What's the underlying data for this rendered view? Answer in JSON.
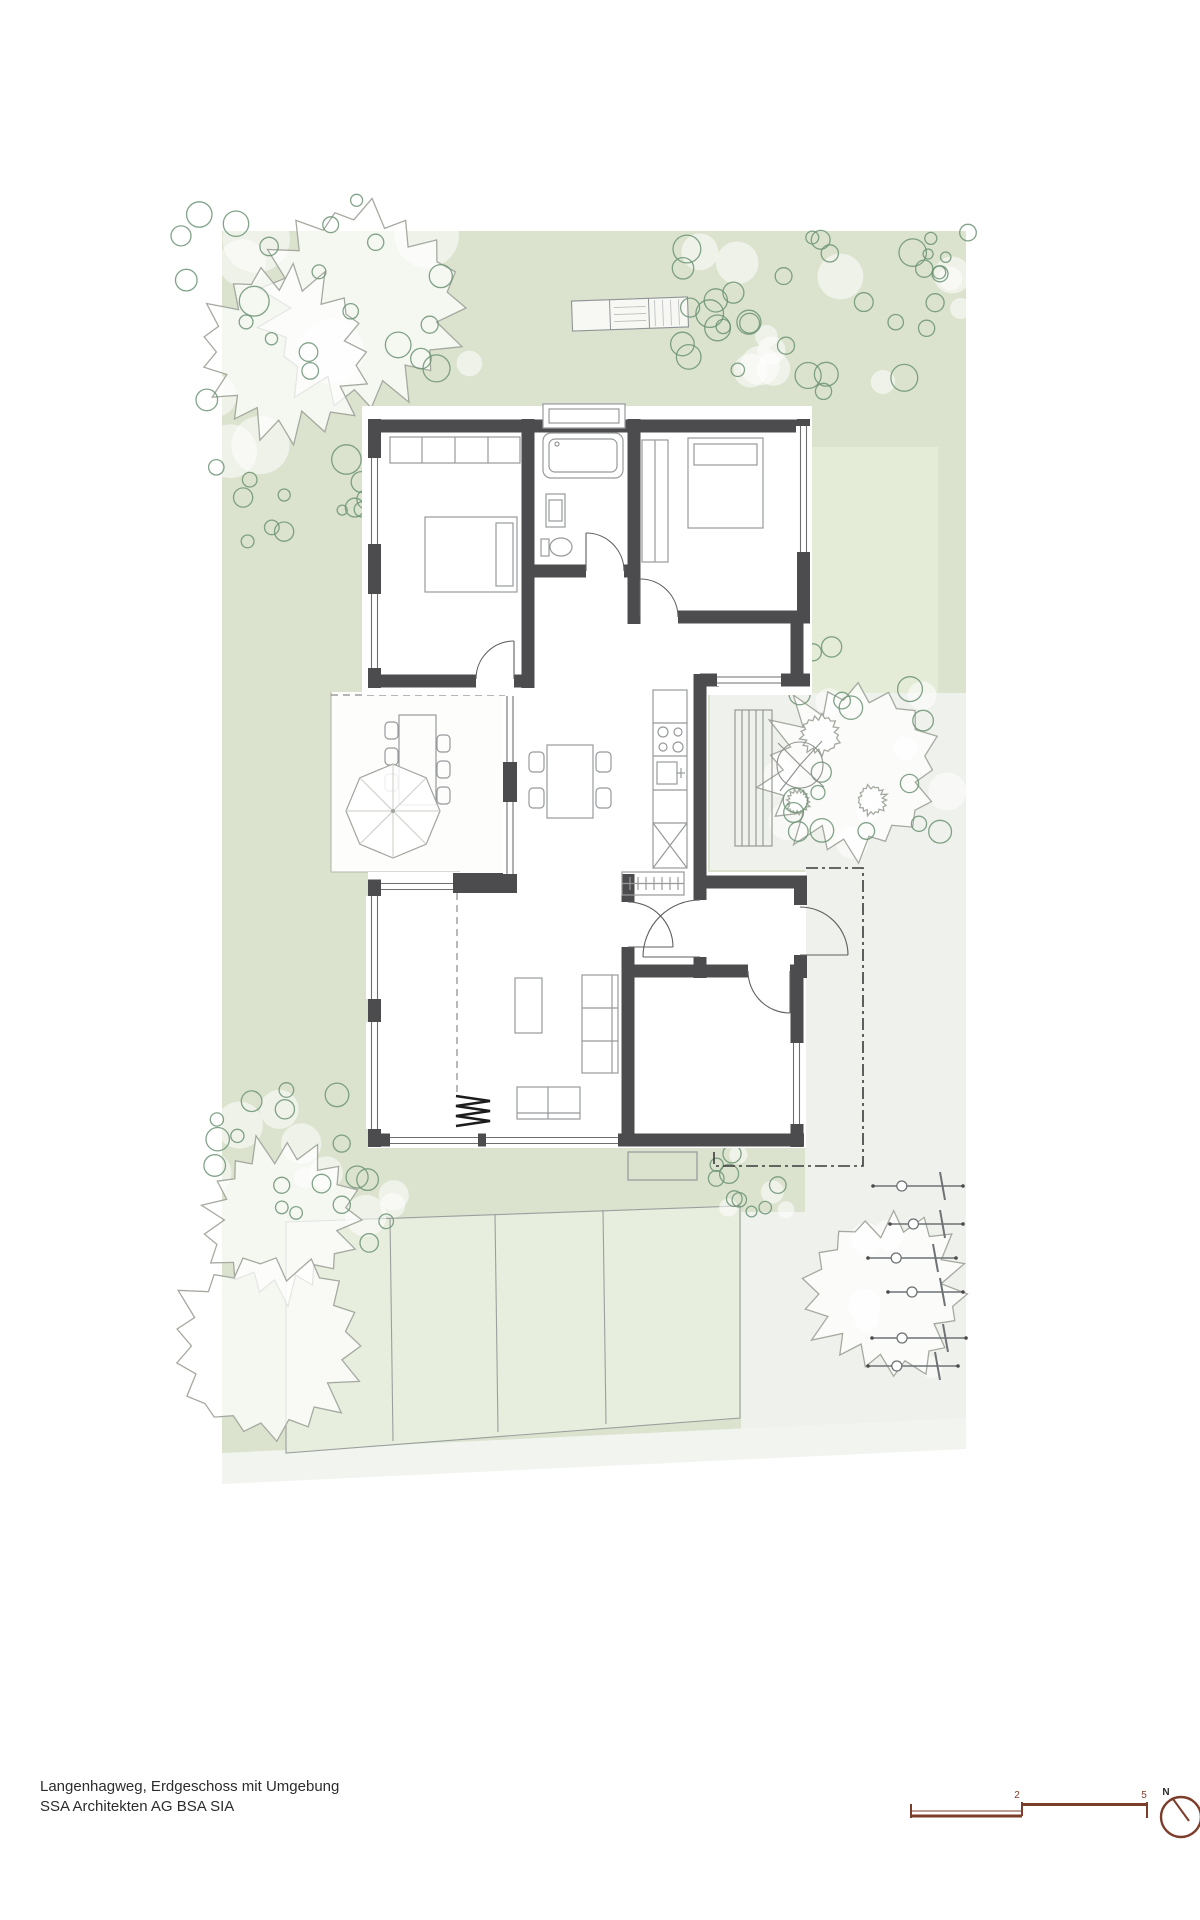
{
  "title_block": {
    "line1": "Langenhagweg, Erdgeschoss mit Umgebung",
    "line2": "SSA Architekten AG BSA SIA"
  },
  "scale_bar": {
    "tick_labels": [
      "2",
      "5"
    ]
  },
  "north_arrow": {
    "label": "N"
  },
  "palette": {
    "site_green": "#dbe3ce",
    "bed": "#e8eede",
    "light_patch": "#e4ebd7",
    "paved": "#eff1ec",
    "band": "#f2f4ef",
    "wall": "#4c4c4e",
    "furn": "#97999b",
    "win": "#6e6e6e",
    "door": "#5f5f5f",
    "shrub": "#6c9374",
    "canopy": "#a5aaa0",
    "deck": "#8e938e",
    "scale": "#7c3d2b",
    "text": "#2c2c2c",
    "dashdot": "#3a3a3a"
  }
}
